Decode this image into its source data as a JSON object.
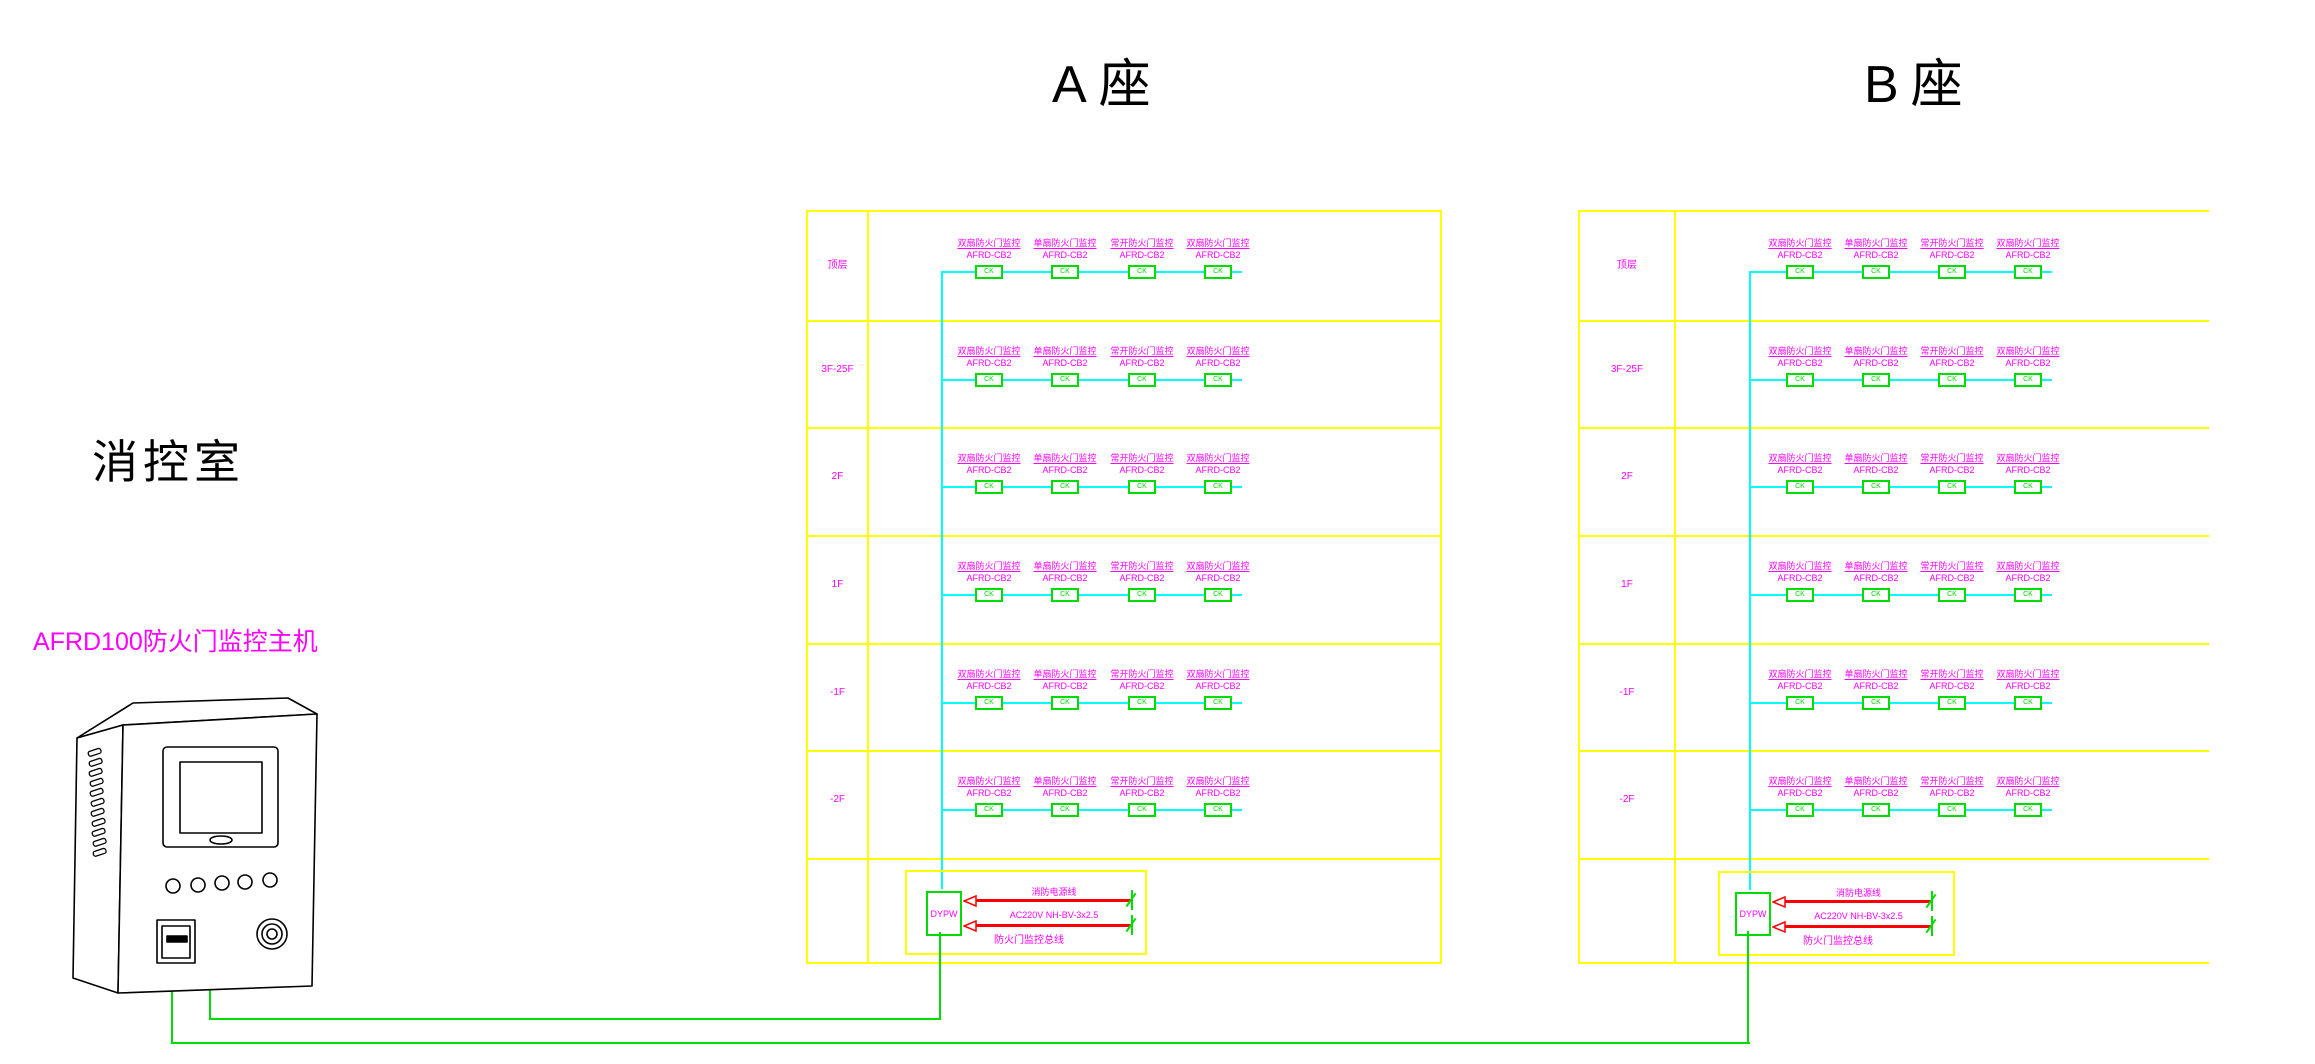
{
  "drawing": {
    "room_label": "消控室",
    "host_label": "AFRD100防火门监控主机"
  },
  "buildings": [
    {
      "id": "A",
      "title": "A座"
    },
    {
      "id": "B",
      "title": "B座"
    }
  ],
  "floors": [
    "顶层",
    "3F-25F",
    "2F",
    "1F",
    "-1F",
    "-2F"
  ],
  "device_columns": [
    {
      "title": "双扇防火门监控",
      "model": "AFRD-CB2",
      "tag": "CK"
    },
    {
      "title": "单扇防火门监控",
      "model": "AFRD-CB2",
      "tag": "CK"
    },
    {
      "title": "常开防火门监控",
      "model": "AFRD-CB2",
      "tag": "CK"
    },
    {
      "title": "双扇防火门监控",
      "model": "AFRD-CB2",
      "tag": "CK"
    }
  ],
  "power_box": {
    "unit_label": "DYPW",
    "line1": "消防电源线",
    "line2": "AC220V NH-BV-3x2.5",
    "line3": "防火门监控总线"
  },
  "colors": {
    "grid": "#FFFF00",
    "text": "#FF00FF",
    "bus": "#00FFFF",
    "wire": "#00DC00",
    "power_arrow": "#FF0000",
    "title": "#000000"
  }
}
